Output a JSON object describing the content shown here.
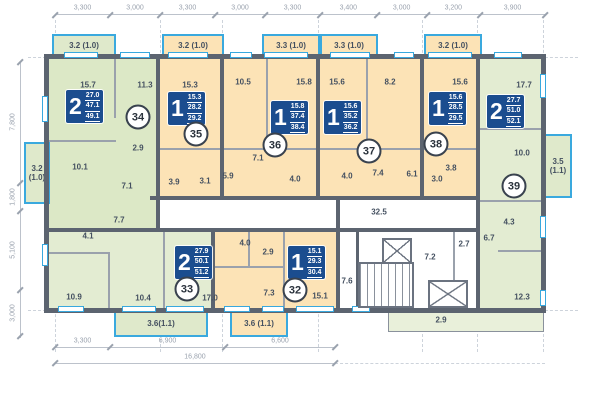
{
  "colors": {
    "apartment_green": "#dce8c6",
    "apartment_green_light": "#e3ecd2",
    "apartment_orange": "#fce3b6",
    "wall_gray": "#5c6470",
    "window_blue": "#3aa9de",
    "info_plate_navy": "#1b4d8f",
    "dimension_text": "#9aa2ae",
    "label_text": "#445060"
  },
  "dims": {
    "top": [
      "3,300",
      "3,000",
      "3,300",
      "3,000",
      "3,300",
      "3,400",
      "3,000",
      "3,200",
      "3,900"
    ],
    "left": [
      "7,800",
      "1,800",
      "5,100",
      "3,000"
    ],
    "bottom": [
      "3,300",
      "6,900",
      "6,600"
    ],
    "bottom_total": "16,800"
  },
  "apartments": [
    {
      "num": "34",
      "rooms": "2",
      "areas": [
        "27.0",
        "47.1",
        "49.1"
      ],
      "block": {
        "x": 66,
        "y": 90
      },
      "circle": {
        "x": 138,
        "y": 117
      }
    },
    {
      "num": "35",
      "rooms": "1",
      "areas": [
        "15.3",
        "28.2",
        "29.2"
      ],
      "block": {
        "x": 168,
        "y": 92
      },
      "circle": {
        "x": 196,
        "y": 134
      }
    },
    {
      "num": "36",
      "rooms": "1",
      "areas": [
        "15.8",
        "37.4",
        "38.4"
      ],
      "block": {
        "x": 271,
        "y": 101
      },
      "circle": {
        "x": 275,
        "y": 145
      }
    },
    {
      "num": "37",
      "rooms": "1",
      "areas": [
        "15.6",
        "35.2",
        "36.2"
      ],
      "block": {
        "x": 324,
        "y": 101
      },
      "circle": {
        "x": 369,
        "y": 151
      }
    },
    {
      "num": "38",
      "rooms": "1",
      "areas": [
        "15.6",
        "28.5",
        "29.5"
      ],
      "block": {
        "x": 429,
        "y": 92
      },
      "circle": {
        "x": 436,
        "y": 144
      }
    },
    {
      "num": "39",
      "rooms": "2",
      "areas": [
        "27.7",
        "51.0",
        "52.1"
      ],
      "block": {
        "x": 487,
        "y": 95
      },
      "circle": {
        "x": 514,
        "y": 186
      }
    },
    {
      "num": "33",
      "rooms": "2",
      "areas": [
        "27.9",
        "50.1",
        "51.2"
      ],
      "block": {
        "x": 175,
        "y": 246
      },
      "circle": {
        "x": 187,
        "y": 289
      }
    },
    {
      "num": "32",
      "rooms": "1",
      "areas": [
        "15.1",
        "29.3",
        "30.4"
      ],
      "block": {
        "x": 288,
        "y": 246
      },
      "circle": {
        "x": 295,
        "y": 290
      }
    }
  ],
  "room_labels": [
    {
      "t": "15.7",
      "x": 88,
      "y": 85
    },
    {
      "t": "11.3",
      "x": 145,
      "y": 85
    },
    {
      "t": "10.1",
      "x": 80,
      "y": 167
    },
    {
      "t": "2.9",
      "x": 138,
      "y": 148
    },
    {
      "t": "7.1",
      "x": 127,
      "y": 186
    },
    {
      "t": "15.3",
      "x": 190,
      "y": 85
    },
    {
      "t": "3.9",
      "x": 174,
      "y": 182
    },
    {
      "t": "3.1",
      "x": 205,
      "y": 181
    },
    {
      "t": "5.9",
      "x": 228,
      "y": 176
    },
    {
      "t": "10.5",
      "x": 243,
      "y": 82
    },
    {
      "t": "15.8",
      "x": 304,
      "y": 82
    },
    {
      "t": "7.1",
      "x": 258,
      "y": 158
    },
    {
      "t": "4.0",
      "x": 295,
      "y": 179
    },
    {
      "t": "15.6",
      "x": 337,
      "y": 82
    },
    {
      "t": "8.2",
      "x": 390,
      "y": 82
    },
    {
      "t": "4.0",
      "x": 347,
      "y": 176
    },
    {
      "t": "7.4",
      "x": 378,
      "y": 173
    },
    {
      "t": "15.6",
      "x": 460,
      "y": 82
    },
    {
      "t": "6.1",
      "x": 412,
      "y": 174
    },
    {
      "t": "3.8",
      "x": 451,
      "y": 168
    },
    {
      "t": "3.0",
      "x": 437,
      "y": 179
    },
    {
      "t": "17.7",
      "x": 524,
      "y": 85
    },
    {
      "t": "10.0",
      "x": 522,
      "y": 153
    },
    {
      "t": "4.3",
      "x": 509,
      "y": 222
    },
    {
      "t": "6.7",
      "x": 489,
      "y": 238
    },
    {
      "t": "12.3",
      "x": 522,
      "y": 297
    },
    {
      "t": "4.1",
      "x": 88,
      "y": 236
    },
    {
      "t": "7.7",
      "x": 119,
      "y": 220
    },
    {
      "t": "10.9",
      "x": 74,
      "y": 297
    },
    {
      "t": "10.4",
      "x": 143,
      "y": 298
    },
    {
      "t": "17.0",
      "x": 210,
      "y": 298
    },
    {
      "t": "4.0",
      "x": 245,
      "y": 243
    },
    {
      "t": "2.9",
      "x": 268,
      "y": 252
    },
    {
      "t": "7.3",
      "x": 269,
      "y": 293
    },
    {
      "t": "15.1",
      "x": 320,
      "y": 296
    },
    {
      "t": "32.5",
      "x": 379,
      "y": 212
    },
    {
      "t": "7.6",
      "x": 347,
      "y": 281
    },
    {
      "t": "7.2",
      "x": 430,
      "y": 257
    },
    {
      "t": "2.7",
      "x": 464,
      "y": 244
    },
    {
      "t": "2.9",
      "x": 441,
      "y": 320
    }
  ],
  "balconies": [
    {
      "t": "3.2 (1.0)",
      "x": 52,
      "y": 34,
      "w": 64,
      "h": 24,
      "c": "g"
    },
    {
      "t": "3.2 (1.0)",
      "x": 162,
      "y": 34,
      "w": 62,
      "h": 24,
      "c": "o"
    },
    {
      "t": "3.3 (1.0)",
      "x": 262,
      "y": 34,
      "w": 58,
      "h": 24,
      "c": "o"
    },
    {
      "t": "3.3 (1.0)",
      "x": 320,
      "y": 34,
      "w": 58,
      "h": 24,
      "c": "o"
    },
    {
      "t": "3.2 (1.0)",
      "x": 424,
      "y": 34,
      "w": 58,
      "h": 24,
      "c": "o"
    },
    {
      "t": "3.2 (1.0)",
      "x": 24,
      "y": 142,
      "w": 26,
      "h": 62,
      "c": "g"
    },
    {
      "t": "3.5 (1.1)",
      "x": 544,
      "y": 134,
      "w": 28,
      "h": 64,
      "c": "g"
    },
    {
      "t": "3.6(1.1)",
      "x": 114,
      "y": 311,
      "w": 94,
      "h": 26,
      "c": "g"
    },
    {
      "t": "3.6 (1.1)",
      "x": 230,
      "y": 311,
      "w": 58,
      "h": 26,
      "c": "o"
    }
  ]
}
